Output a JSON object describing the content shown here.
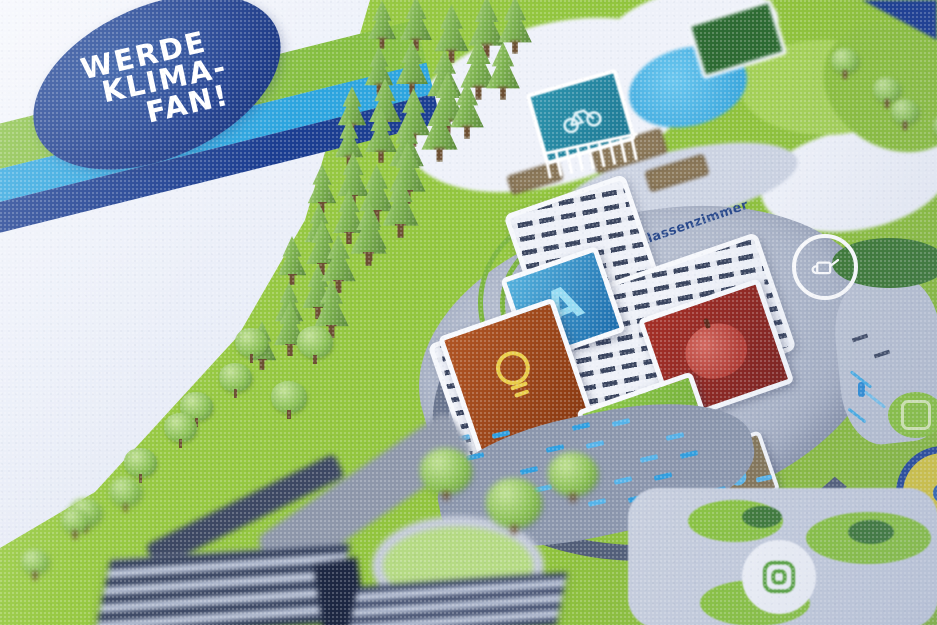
{
  "badge": {
    "line1": "WERDE",
    "line2": "KLIMA-",
    "line3": "FAN!",
    "bg_color": "#1a3a8c",
    "text_color": "#ffffff"
  },
  "stripes": {
    "green": "#86bf42",
    "light_blue": "#2ea5df",
    "dark_blue": "#1c3e91"
  },
  "map": {
    "label_green_classroom": "Grünes Klassenzimmer",
    "label_color": "#2a4a8c",
    "lawn_color": "#93c63f",
    "pond_color": "#3fa9dc",
    "plaza_color": "#a7b0c3",
    "building_slat_color": "#3b4660",
    "tiles": {
      "blue": {
        "letter": "A",
        "color": "#2a7fc0",
        "icon": "letter-a"
      },
      "red": {
        "color": "#9e2b22",
        "icon": "apple"
      },
      "orange": {
        "color": "#a84a1e",
        "icon": "lightbulb"
      },
      "green": {
        "color": "#7cbf3e",
        "icon": "battery"
      },
      "brown": {
        "color": "#867656",
        "icon": "water-drop"
      }
    },
    "signs": {
      "bike": {
        "color": "#2789a5",
        "icon": "bicycle"
      }
    },
    "circle_icons": [
      "watering-can",
      "maze",
      "roundabout-target",
      "leaf-badge"
    ]
  }
}
